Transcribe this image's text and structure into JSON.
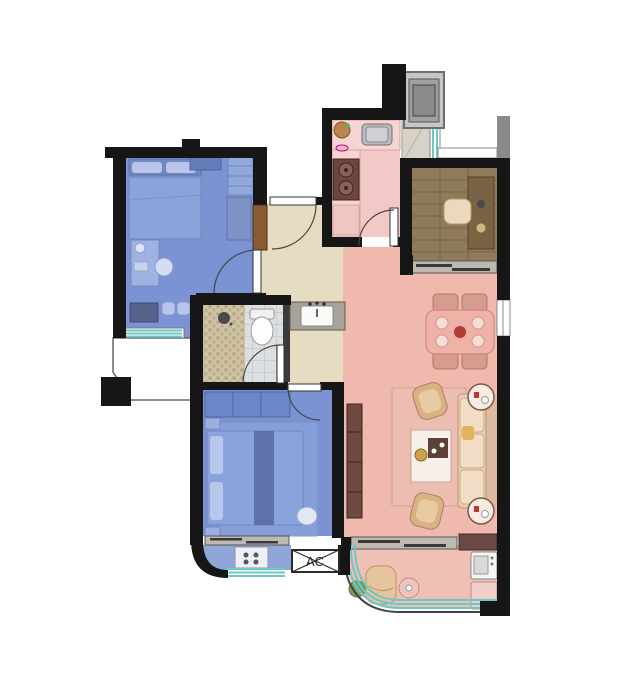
{
  "labels": {
    "ac_unit": "AC"
  },
  "colors": {
    "wall": "#161616",
    "background": "#ffffff",
    "bedroom-floor": "#7b93d2",
    "bedroom2-balcony-floor": "#8ea6d8",
    "kitchen-floor": "#f2c9c6",
    "living-floor": "#f0b9ae",
    "balcony-floor": "#efc0b4",
    "hall-floor": "#e6dcc2",
    "study-floor": "#8f7a5a",
    "glass": "#6cc7c7",
    "frame-gray": "#8a8a8a",
    "wood-door": "#8a5a33",
    "sofa": "#e9cdb2",
    "chair-tan": "#d9b183",
    "table-pink": "#eeb2a8",
    "rug": "#eebdb2",
    "tv-cabinet": "#6e4a41",
    "bed-blue": "#8ba3dd"
  },
  "rooms": [
    {
      "id": "bedroom-1"
    },
    {
      "id": "bedroom-2"
    },
    {
      "id": "kitchen"
    },
    {
      "id": "study"
    },
    {
      "id": "bathroom"
    },
    {
      "id": "entry-hall"
    },
    {
      "id": "living-dining"
    },
    {
      "id": "main-balcony"
    },
    {
      "id": "bedroom-2-balcony"
    },
    {
      "id": "equipment-platform"
    }
  ]
}
